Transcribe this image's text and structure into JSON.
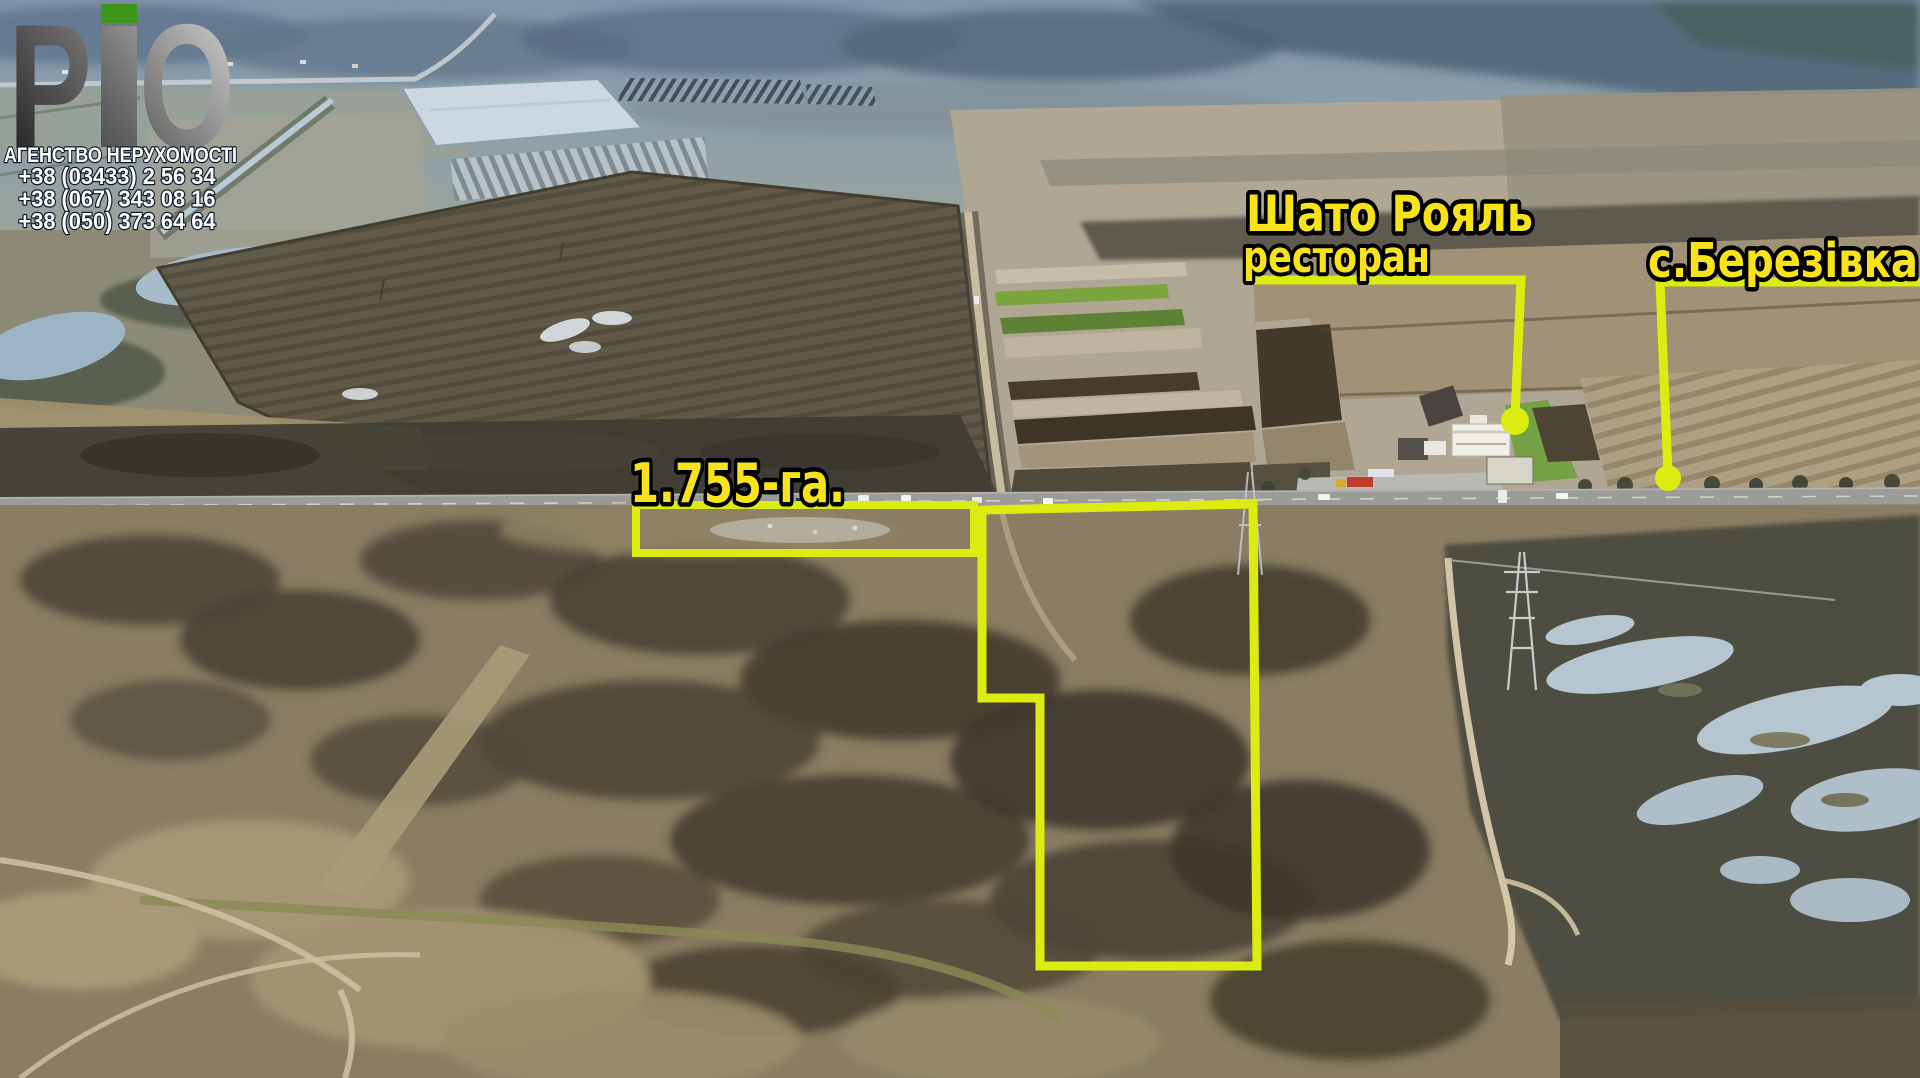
{
  "branding": {
    "logo_text": "РіО",
    "logo_letter_p": "Р",
    "logo_letter_o": "О",
    "agency_line": "АГЕНСТВО НЕРУХОМОСТІ",
    "phones": [
      "+38 (03433) 2 56 34",
      "+38 (067) 343 08 16",
      "+38 (050) 373 64 64"
    ]
  },
  "annotations": {
    "restaurant_title": "Шато Рояль",
    "restaurant_subtitle": "ресторан",
    "village_label": "с.Березівка",
    "area_label": "1.755-га."
  },
  "colors": {
    "annotation_yellow": "#dcec10",
    "text_yellow": "#f6e31c",
    "logo_green": "#3f9719"
  }
}
